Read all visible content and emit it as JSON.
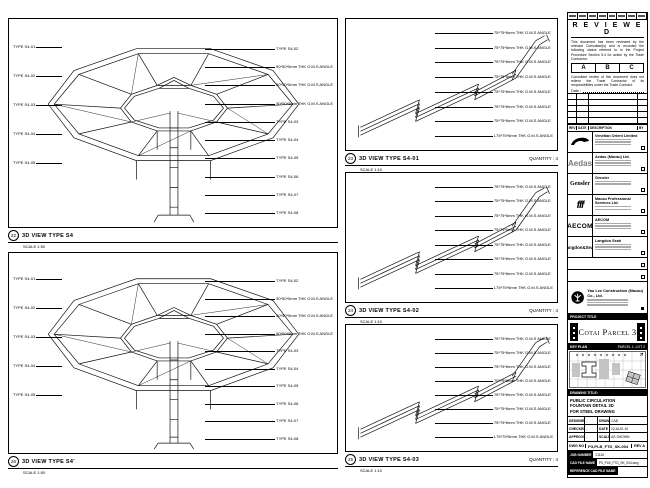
{
  "panels": {
    "left_top": {
      "num": "22",
      "title": "3D VIEW TYPE S4",
      "scale": "SCALE 1:50",
      "callouts_left": [
        "TYPE S4-01",
        "TYPE S4-02",
        "TYPE S4-03",
        "TYPE S4-04",
        "TYPE S4-05"
      ],
      "callouts_right": [
        "TYPE S4-02",
        "50*50*5mm THK G.M.S ANGLE",
        "50*50*5mm THK G.M.S ANGLE",
        "50*50*5mm THK G.M.S ANGLE",
        "TYPE S4-03",
        "TYPE S4-04",
        "TYPE S4-05",
        "TYPE S4-06",
        "TYPE S4-07",
        "TYPE S4-08"
      ]
    },
    "left_bottom": {
      "num": "26",
      "title": "3D VIEW TYPE S4'",
      "scale": "SCALE 1:50",
      "callouts_left": [
        "TYPE S4-01",
        "TYPE S4-02",
        "TYPE S4-03",
        "TYPE S4-04",
        "TYPE S4-05"
      ],
      "callouts_right": [
        "TYPE S4-02",
        "50*50*5mm THK G.M.S ANGLE",
        "50*50*5mm THK G.M.S ANGLE",
        "50*50*5mm THK G.M.S ANGLE",
        "TYPE S4-03",
        "TYPE S4-04",
        "TYPE S4-05",
        "TYPE S4-06",
        "TYPE S4-07",
        "TYPE S4-08"
      ]
    },
    "mid_top": {
      "num": "23",
      "title": "3D VIEW TYPE S4-01",
      "quantity": "QUANTITY : 4",
      "scale": "SCALE 1:10",
      "callouts": [
        "75*75*6mm THK G.M.S ANGLE",
        "75*75*6mm THK G.M.S ANGLE",
        "75*75*6mm THK G.M.S ANGLE",
        "75*75*6mm THK G.M.S ANGLE",
        "75*75*6mm THK G.M.S ANGLE",
        "75*75*6mm THK G.M.S ANGLE",
        "75*75*6mm THK G.M.S ANGLE",
        "L75*75*6mm THK G.M.S ANGLE"
      ]
    },
    "mid_mid": {
      "num": "24",
      "title": "3D VIEW TYPE S4-02",
      "quantity": "QUANTITY : 4",
      "scale": "SCALE 1:10",
      "callouts": [
        "75*75*6mm THK G.M.S ANGLE",
        "75*75*6mm THK G.M.S ANGLE",
        "75*75*6mm THK G.M.S ANGLE",
        "75*75*6mm THK G.M.S ANGLE",
        "75*75*6mm THK G.M.S ANGLE",
        "75*75*6mm THK G.M.S ANGLE",
        "75*75*6mm THK G.M.S ANGLE",
        "L75*75*6mm THK G.M.S ANGLE"
      ]
    },
    "mid_bottom": {
      "num": "25",
      "title": "3D VIEW TYPE S4-03",
      "quantity": "QUANTITY : 4",
      "scale": "SCALE 1:10",
      "callouts": [
        "75*75*6mm THK G.M.S ANGLE",
        "75*75*6mm THK G.M.S ANGLE",
        "75*75*6mm THK G.M.S ANGLE",
        "75*75*6mm THK G.M.S ANGLE",
        "75*75*6mm THK G.M.S ANGLE",
        "75*75*6mm THK G.M.S ANGLE",
        "75*75*6mm THK G.M.S ANGLE",
        "L75*75*6mm THK G.M.S ANGLE"
      ]
    }
  },
  "titleblock": {
    "stamp": {
      "title": "R E V I E W E D",
      "para1": "This document has been reviewed by the relevant Consultant(s) and is recorded the following status referred to in the Project Procedure Section 5.4 for action by the Trade Contractor.",
      "grades": [
        "A",
        "B",
        "C"
      ],
      "para2": "Consultant review of this document does not relieve the Trade Contractor of its responsibilities under the Trade Contract.",
      "date_label": "Date :"
    },
    "rev_table": {
      "headers": [
        "REV",
        "DATE",
        "DESCRIPTION",
        "BY"
      ]
    },
    "consultants": [
      {
        "logo": "",
        "name": "Venetian Orient Limited"
      },
      {
        "logo": "Aedas",
        "name": "Aedas (Macau) Ltd."
      },
      {
        "logo": "Gensler",
        "name": "Gensler"
      },
      {
        "logo": "fff",
        "name": "Macau Professional Services Ltd."
      },
      {
        "logo": "AECOM",
        "name": "AECOM"
      },
      {
        "logo": "Langdon&Seah",
        "name": "Langdon Seah"
      }
    ],
    "contractor": {
      "name": "Yau Lee Construction (Macau) Co., Ltd."
    },
    "project": {
      "label": "PROJECT TITLE",
      "name": "Cotai Parcel 3"
    },
    "keyplan": {
      "label": "KEY PLAN",
      "parcel": "PARCEL 1, LOT 2"
    },
    "drawing_title": {
      "label": "DRAWING TITLE:",
      "lines": [
        "PUBLIC CIRCULATION",
        "FOUNTAIN DETAIL 3D",
        "FOR STEEL DRAWING"
      ]
    },
    "info": {
      "designed_label": "DESIGNED",
      "designed": "-",
      "drawn_label": "DRAWN",
      "drawn": "CAD",
      "checked_label": "CHECKED",
      "checked": "-",
      "date_label": "DATE",
      "date": "12-AUG-10",
      "approved_label": "APPROVED",
      "approved": "-",
      "scale_label": "SCALE",
      "scale": "AS SHOWN"
    },
    "dwg": {
      "label": "DWG NO",
      "value": "P3-PLB_FTD_SK-004",
      "rev": "REV A"
    },
    "job": {
      "label": "JOB NUMBER",
      "value": "21126"
    },
    "cad": {
      "label": "CAD FILE NAME",
      "value": "P3_PLB_FTD_SK_004.dwg"
    },
    "ref": {
      "label": "REFERENCE CAD FILE NAME",
      "value": ""
    }
  }
}
